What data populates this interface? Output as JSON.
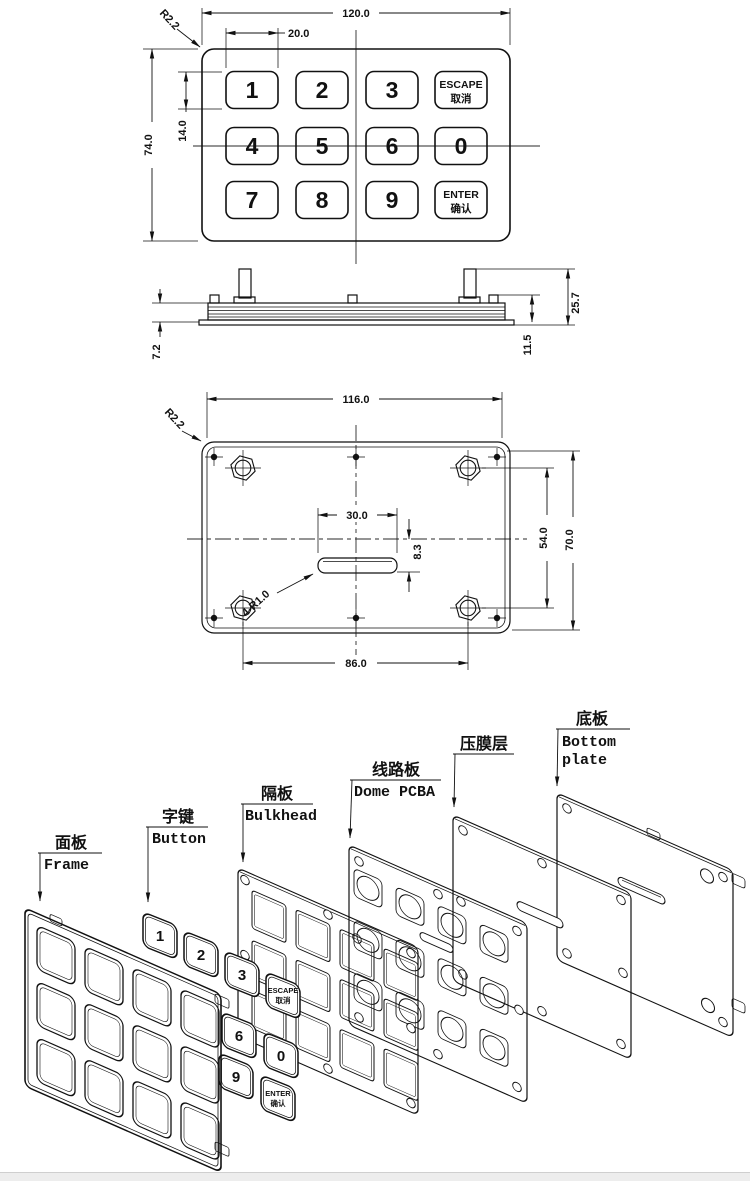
{
  "top_view": {
    "dim_width": "120.0",
    "dim_key_width": "20.0",
    "dim_height": "74.0",
    "dim_key_height": "14.0",
    "dim_corner_radius": "R2.2",
    "keys": [
      {
        "label": "1"
      },
      {
        "label": "2"
      },
      {
        "label": "3"
      },
      {
        "line1": "ESCAPE",
        "line2": "取消"
      },
      {
        "label": "4"
      },
      {
        "label": "5"
      },
      {
        "label": "6"
      },
      {
        "label": "0"
      },
      {
        "label": "7"
      },
      {
        "label": "8"
      },
      {
        "label": "9"
      },
      {
        "line1": "ENTER",
        "line2": "确认"
      }
    ]
  },
  "side_view": {
    "dim_total_height": "25.7",
    "dim_stud_height": "11.5",
    "dim_panel_thickness": "7.2"
  },
  "bottom_view": {
    "dim_width": "116.0",
    "dim_corner_radius": "R2.2",
    "dim_slot_width": "30.0",
    "dim_slot_offset": "8.3",
    "dim_slot_corner_radius": "4-R1.0",
    "dim_mount_spacing_x": "86.0",
    "dim_mount_spacing_y": "54.0",
    "dim_hole_spacing_y": "70.0"
  },
  "exploded_view": {
    "labels": [
      {
        "zh": "面板",
        "en": "Frame"
      },
      {
        "zh": "字键",
        "en": "Button"
      },
      {
        "zh": "隔板",
        "en": "Bulkhead"
      },
      {
        "zh": "线路板",
        "en": "Dome PCBA"
      },
      {
        "zh": "压膜层",
        "en": ""
      },
      {
        "zh": "底板",
        "en_line1": "Bottom",
        "en_line2": "plate"
      }
    ],
    "buttons": [
      {
        "label": "1"
      },
      {
        "label": "2"
      },
      {
        "label": "3"
      },
      {
        "line1": "ESCAPE",
        "line2": "取消"
      },
      {
        "label": "6"
      },
      {
        "label": "0"
      },
      {
        "label": "9"
      },
      {
        "line1": "ENTER",
        "line2": "确认"
      }
    ]
  }
}
